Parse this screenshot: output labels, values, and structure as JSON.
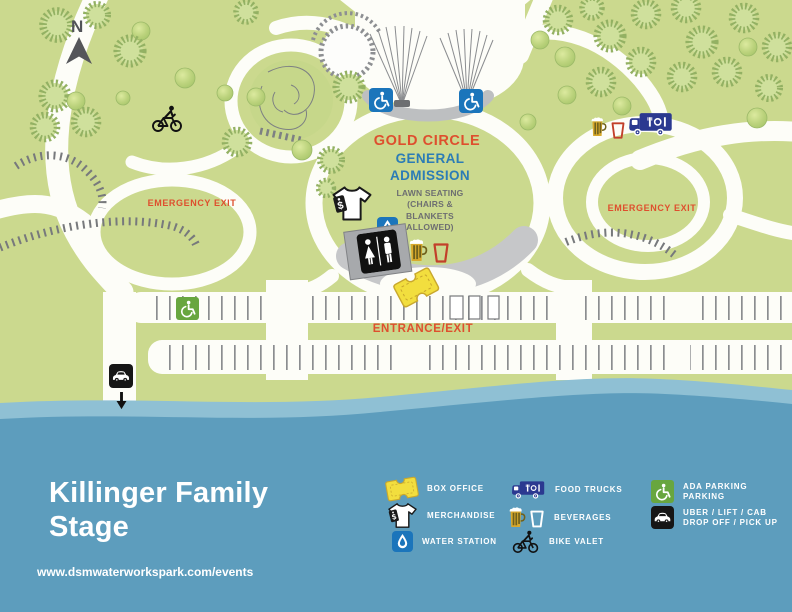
{
  "map": {
    "compass": "N",
    "labels": {
      "gold_circle": "GOLD CIRCLE",
      "general_admission": "GENERAL ADMISSION",
      "lawn_seating": "LAWN SEATING (CHAIRS & BLANKETS ALLOWED)",
      "emergency_exit_left": "EMERGENCY EXIT",
      "emergency_exit_right": "EMERGENCY EXIT",
      "entrance_exit": "ENTRANCE/EXIT"
    }
  },
  "footer": {
    "title_line1": "Killinger Family",
    "title_line2": "Stage",
    "url": "www.dsmwaterworkspark.com/events"
  },
  "legend": {
    "columns": [
      {
        "items": [
          {
            "icon": "ticket-icon",
            "label": "BOX OFFICE"
          },
          {
            "icon": "tshirt-icon",
            "label": "MERCHANDISE"
          },
          {
            "icon": "water-drop-icon",
            "label": "WATER STATION"
          }
        ]
      },
      {
        "items": [
          {
            "icon": "food-truck-icon",
            "label": "FOOD TRUCKS"
          },
          {
            "icon": "beverages-icon",
            "label": "BEVERAGES"
          },
          {
            "icon": "bike-icon",
            "label": "BIKE VALET"
          }
        ]
      },
      {
        "items": [
          {
            "icon": "ada-parking-icon",
            "label": "ADA PARKING",
            "label2": "PARKING"
          },
          {
            "icon": "car-icon",
            "label": "UBER / LIFT / CAB",
            "label2": "DROP OFF / PICK UP"
          }
        ]
      }
    ]
  },
  "colors": {
    "park_green": "#cbd98e",
    "water_blue": "#5d9dbd",
    "water_light": "#8fc0d4",
    "accent_red": "#de4f2e",
    "accent_blue": "#2b7cb6",
    "ada_blue": "#1b75bb",
    "ada_green": "#68a63f",
    "truck_navy": "#2b3990",
    "ticket_yellow": "#f2de3e",
    "text_gray": "#6d6e71"
  }
}
